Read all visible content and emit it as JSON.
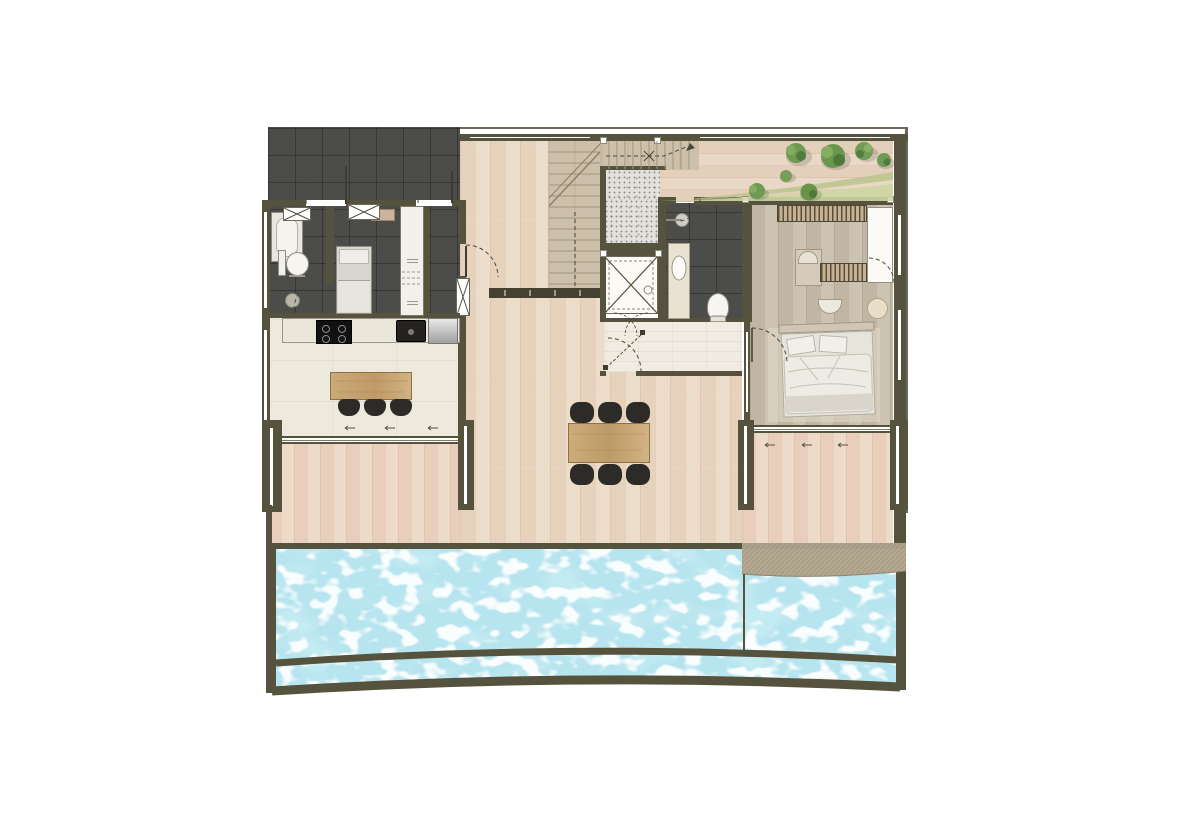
{
  "meta": {
    "kind": "architectural floor plan, beachfront villa level with pool",
    "visible_text": "none (appliance micro-labels illegible)"
  },
  "palette": {
    "wall": "#55533e",
    "dark_tile": "#4c4c4b",
    "interior_wood": "#ead9c5",
    "deck_wood": "#ecd6c4",
    "bedroom_wood": "#c8beac",
    "kitchen_floor": "#edeadd",
    "white_tile": "#f0ece1",
    "stair_wood": "#cdc0aa",
    "stone_speckle": "#e2e1dc",
    "pool_water": "#b6e4ef",
    "pool_water_deep": "#8fd4e2",
    "stone_band": "#b4a891",
    "grass": "#cdd6a3",
    "tree_green": "#6f9a53",
    "furniture_wood": "#c9a876",
    "seat_black": "#2d2b27"
  },
  "rooms": [
    {
      "name": "utility terrace (dark tiled)"
    },
    {
      "name": "staff bathroom"
    },
    {
      "name": "staff bedroom"
    },
    {
      "name": "kitchen"
    },
    {
      "name": "entry hall"
    },
    {
      "name": "staircase"
    },
    {
      "name": "elevator"
    },
    {
      "name": "stone shower / laundry niche"
    },
    {
      "name": "guest bathroom"
    },
    {
      "name": "inner hallway"
    },
    {
      "name": "master bedroom"
    },
    {
      "name": "living / dining terrace"
    },
    {
      "name": "planted roof terrace"
    },
    {
      "name": "pool deck"
    },
    {
      "name": "swimming pool"
    }
  ],
  "furniture": {
    "kitchen_island_stools": 3,
    "dining_chairs": 6,
    "cooktop_burners": 4,
    "beds": 2,
    "toilets": 2,
    "bathtub": 1,
    "terrace_shrubs": 7
  },
  "pool": {
    "shape": "full-width curved infinity pool with overflow gutter",
    "right_feature": "curved stone shelf / beach entry",
    "water_color": "#b6e4ef"
  }
}
